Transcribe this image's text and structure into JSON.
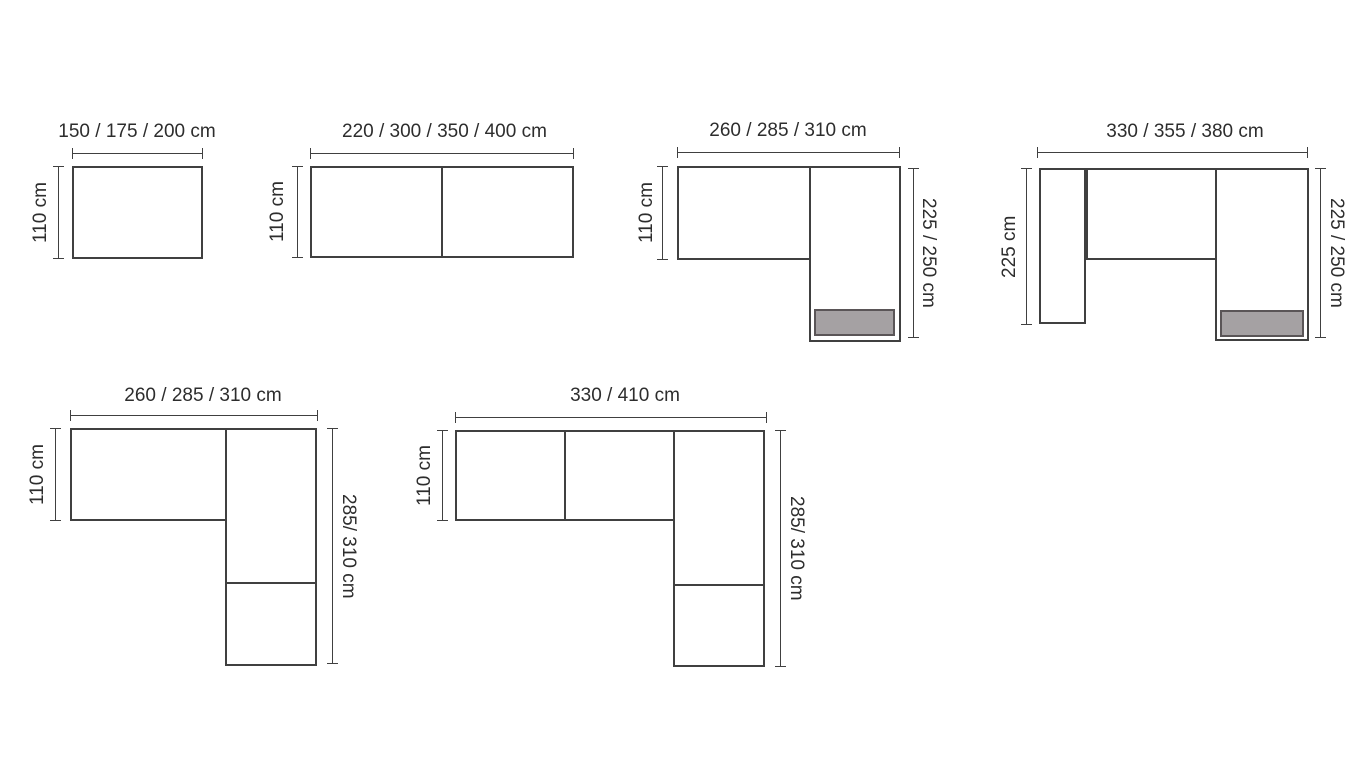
{
  "colors": {
    "background": "#ffffff",
    "line": "#404040",
    "text": "#2d2d2d",
    "footrest_fill": "#a5a1a3",
    "footrest_border": "#5a5557"
  },
  "diagrams": [
    {
      "width_label": "150 / 175 / 200 cm",
      "left_label": "110 cm"
    },
    {
      "width_label": "220 / 300 / 350 / 400 cm",
      "left_label": "110 cm"
    },
    {
      "width_label": "260 / 285 / 310 cm",
      "left_label": "110 cm",
      "right_label": "225 / 250 cm"
    },
    {
      "width_label": "330 / 355 / 380 cm",
      "left_label": "225 cm",
      "right_label": "225 / 250 cm"
    },
    {
      "width_label": "260 / 285 / 310 cm",
      "left_label": "110 cm",
      "right_label": "285/ 310 cm"
    },
    {
      "width_label": "330 / 410 cm",
      "left_label": "110 cm",
      "right_label": "285/ 310 cm"
    }
  ]
}
